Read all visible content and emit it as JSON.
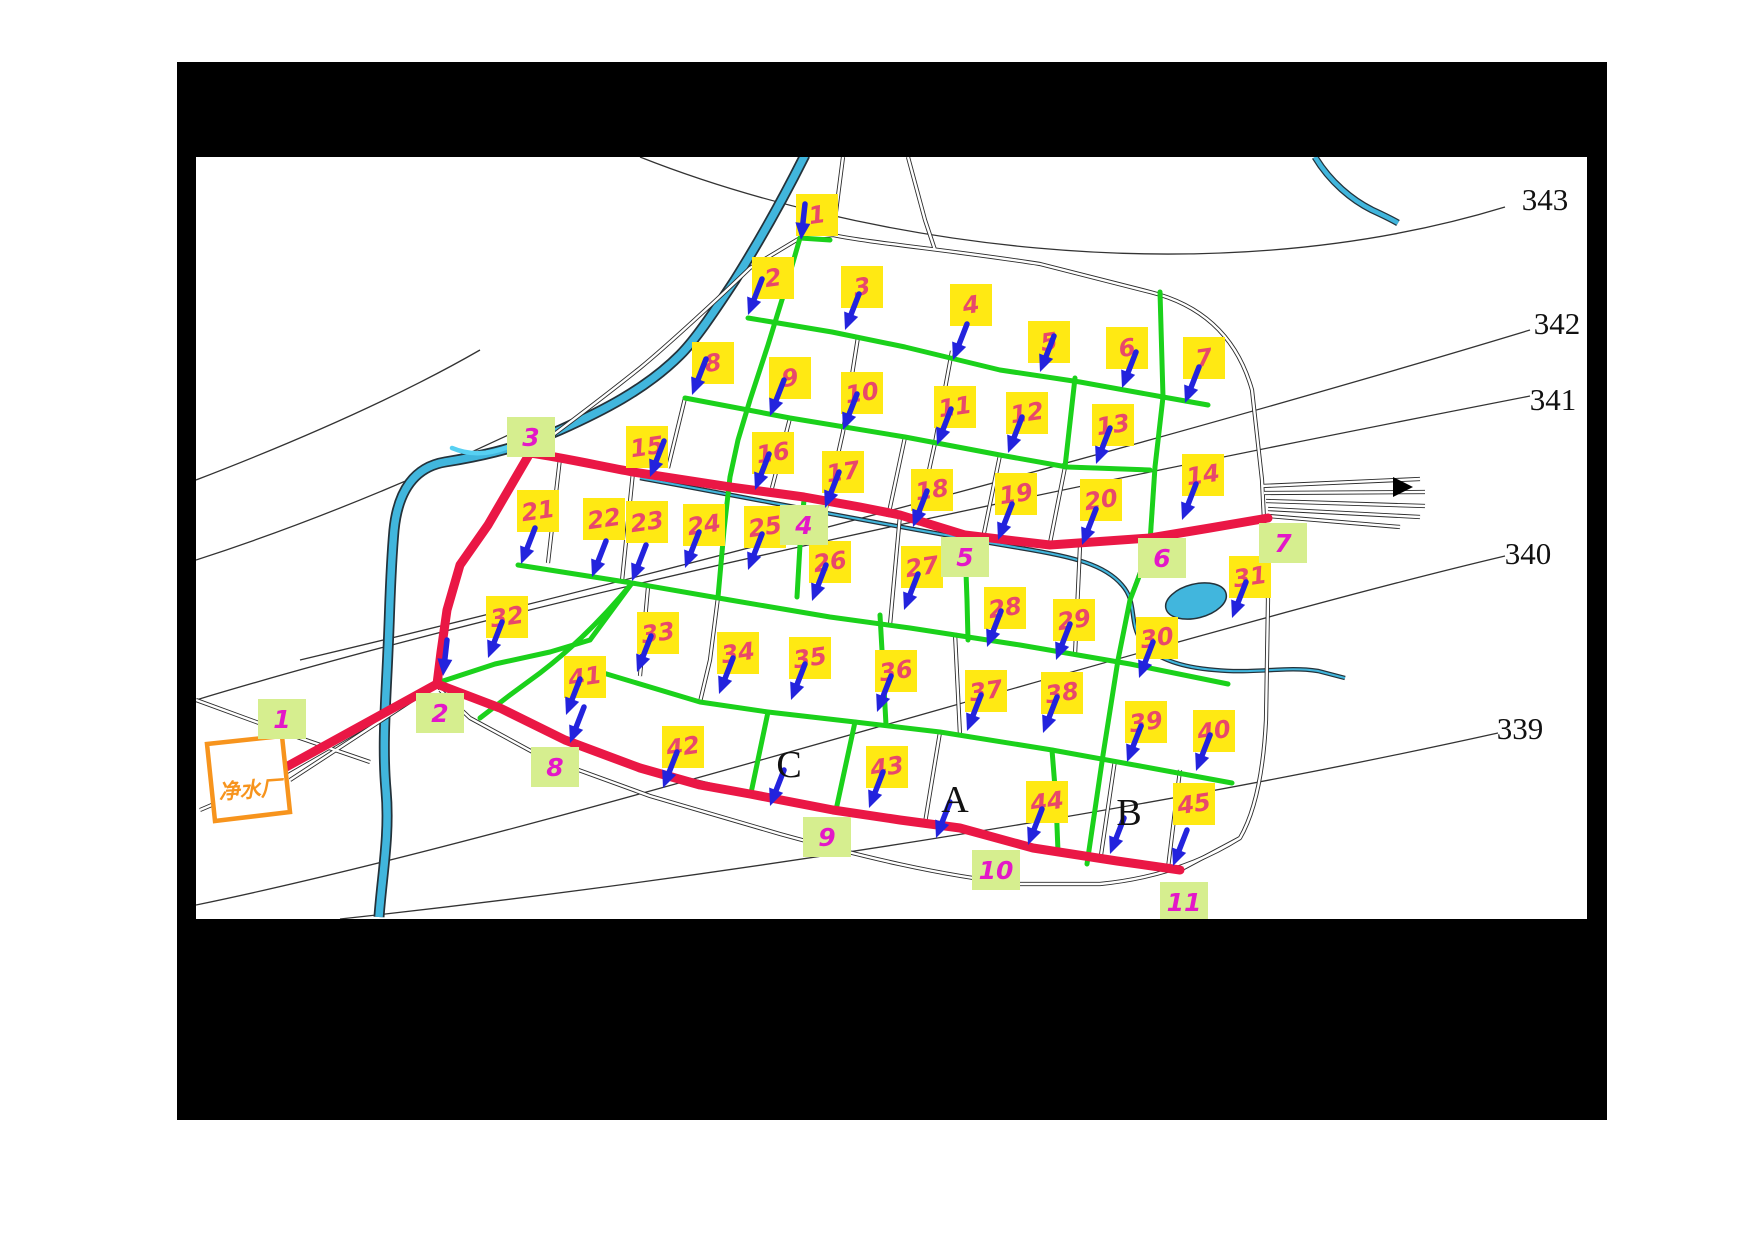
{
  "map": {
    "title": "water-supply-network-plan",
    "plant": {
      "label": "净水厂"
    },
    "contour_labels": [
      {
        "text": "343",
        "x": 1545,
        "y": 199
      },
      {
        "text": "342",
        "x": 1557,
        "y": 323
      },
      {
        "text": "341",
        "x": 1553,
        "y": 399
      },
      {
        "text": "340",
        "x": 1528,
        "y": 553
      },
      {
        "text": "339",
        "x": 1520,
        "y": 728
      }
    ],
    "block_letters": [
      {
        "text": "C",
        "x": 789,
        "y": 765
      },
      {
        "text": "A",
        "x": 955,
        "y": 800
      },
      {
        "text": "B",
        "x": 1129,
        "y": 813
      }
    ],
    "yellow_nodes": [
      {
        "id": "1",
        "x": 817,
        "y": 215
      },
      {
        "id": "2",
        "x": 773,
        "y": 278
      },
      {
        "id": "3",
        "x": 862,
        "y": 287
      },
      {
        "id": "4",
        "x": 971,
        "y": 305
      },
      {
        "id": "5",
        "x": 1049,
        "y": 342
      },
      {
        "id": "6",
        "x": 1127,
        "y": 348
      },
      {
        "id": "7",
        "x": 1204,
        "y": 358
      },
      {
        "id": "8",
        "x": 713,
        "y": 363
      },
      {
        "id": "9",
        "x": 790,
        "y": 378
      },
      {
        "id": "10",
        "x": 862,
        "y": 393
      },
      {
        "id": "11",
        "x": 955,
        "y": 407
      },
      {
        "id": "12",
        "x": 1027,
        "y": 413
      },
      {
        "id": "13",
        "x": 1113,
        "y": 425
      },
      {
        "id": "14",
        "x": 1203,
        "y": 475
      },
      {
        "id": "15",
        "x": 647,
        "y": 447
      },
      {
        "id": "16",
        "x": 773,
        "y": 453
      },
      {
        "id": "17",
        "x": 843,
        "y": 472
      },
      {
        "id": "18",
        "x": 932,
        "y": 490
      },
      {
        "id": "19",
        "x": 1016,
        "y": 494
      },
      {
        "id": "20",
        "x": 1101,
        "y": 500
      },
      {
        "id": "21",
        "x": 538,
        "y": 511
      },
      {
        "id": "22",
        "x": 604,
        "y": 519
      },
      {
        "id": "23",
        "x": 647,
        "y": 522
      },
      {
        "id": "24",
        "x": 704,
        "y": 525
      },
      {
        "id": "25",
        "x": 765,
        "y": 527
      },
      {
        "id": "26",
        "x": 830,
        "y": 562
      },
      {
        "id": "27",
        "x": 922,
        "y": 567
      },
      {
        "id": "28",
        "x": 1005,
        "y": 608
      },
      {
        "id": "29",
        "x": 1074,
        "y": 620
      },
      {
        "id": "30",
        "x": 1157,
        "y": 638
      },
      {
        "id": "31",
        "x": 1250,
        "y": 577
      },
      {
        "id": "32",
        "x": 507,
        "y": 617
      },
      {
        "id": "33",
        "x": 658,
        "y": 633
      },
      {
        "id": "34",
        "x": 738,
        "y": 653
      },
      {
        "id": "35",
        "x": 810,
        "y": 658
      },
      {
        "id": "36",
        "x": 896,
        "y": 671
      },
      {
        "id": "37",
        "x": 986,
        "y": 691
      },
      {
        "id": "38",
        "x": 1062,
        "y": 693
      },
      {
        "id": "39",
        "x": 1146,
        "y": 722
      },
      {
        "id": "40",
        "x": 1214,
        "y": 731
      },
      {
        "id": "41",
        "x": 585,
        "y": 677
      },
      {
        "id": "42",
        "x": 683,
        "y": 747
      },
      {
        "id": "43",
        "x": 887,
        "y": 767
      },
      {
        "id": "44",
        "x": 1047,
        "y": 802
      },
      {
        "id": "45",
        "x": 1194,
        "y": 804
      }
    ],
    "green_nodes": [
      {
        "id": "1",
        "x": 282,
        "y": 719
      },
      {
        "id": "2",
        "x": 440,
        "y": 713
      },
      {
        "id": "3",
        "x": 531,
        "y": 437
      },
      {
        "id": "4",
        "x": 804,
        "y": 525
      },
      {
        "id": "5",
        "x": 965,
        "y": 557
      },
      {
        "id": "6",
        "x": 1162,
        "y": 558
      },
      {
        "id": "7",
        "x": 1283,
        "y": 543
      },
      {
        "id": "8",
        "x": 555,
        "y": 767
      },
      {
        "id": "9",
        "x": 827,
        "y": 837
      },
      {
        "id": "10",
        "x": 996,
        "y": 870
      },
      {
        "id": "11",
        "x": 1184,
        "y": 902
      }
    ],
    "arrows": [
      {
        "x": 801,
        "y": 240,
        "v": true
      },
      {
        "x": 748,
        "y": 315
      },
      {
        "x": 845,
        "y": 330
      },
      {
        "x": 953,
        "y": 360
      },
      {
        "x": 1040,
        "y": 372
      },
      {
        "x": 1122,
        "y": 388
      },
      {
        "x": 1185,
        "y": 403
      },
      {
        "x": 692,
        "y": 395
      },
      {
        "x": 770,
        "y": 416
      },
      {
        "x": 843,
        "y": 430
      },
      {
        "x": 937,
        "y": 445
      },
      {
        "x": 1008,
        "y": 453
      },
      {
        "x": 1096,
        "y": 464
      },
      {
        "x": 1182,
        "y": 520
      },
      {
        "x": 650,
        "y": 477
      },
      {
        "x": 755,
        "y": 490
      },
      {
        "x": 825,
        "y": 508
      },
      {
        "x": 913,
        "y": 527
      },
      {
        "x": 998,
        "y": 540
      },
      {
        "x": 1082,
        "y": 545
      },
      {
        "x": 521,
        "y": 564
      },
      {
        "x": 592,
        "y": 577
      },
      {
        "x": 632,
        "y": 581
      },
      {
        "x": 685,
        "y": 568
      },
      {
        "x": 748,
        "y": 570
      },
      {
        "x": 812,
        "y": 601
      },
      {
        "x": 904,
        "y": 610
      },
      {
        "x": 987,
        "y": 647
      },
      {
        "x": 1056,
        "y": 660
      },
      {
        "x": 1139,
        "y": 678
      },
      {
        "x": 1232,
        "y": 618
      },
      {
        "x": 488,
        "y": 658
      },
      {
        "x": 637,
        "y": 672
      },
      {
        "x": 719,
        "y": 694
      },
      {
        "x": 791,
        "y": 700
      },
      {
        "x": 877,
        "y": 712
      },
      {
        "x": 967,
        "y": 731
      },
      {
        "x": 1043,
        "y": 733
      },
      {
        "x": 1127,
        "y": 762
      },
      {
        "x": 1196,
        "y": 771
      },
      {
        "x": 566,
        "y": 715
      },
      {
        "x": 663,
        "y": 788
      },
      {
        "x": 869,
        "y": 808
      },
      {
        "x": 1028,
        "y": 845
      },
      {
        "x": 1173,
        "y": 866
      },
      {
        "x": 770,
        "y": 806
      },
      {
        "x": 936,
        "y": 838
      },
      {
        "x": 1110,
        "y": 854
      },
      {
        "x": 443,
        "y": 676,
        "v": true
      },
      {
        "x": 570,
        "y": 743
      }
    ],
    "colors": {
      "frame": "#000000",
      "paper": "#ffffff",
      "trunk_red": "#ea1745",
      "pipe_green": "#1bd11b",
      "node_box": "#ffe913",
      "node_text": "#e8486b",
      "junction_box": "#d6ee8f",
      "junction_text": "#e318c8",
      "arrow_blue": "#2323dd",
      "river_fill": "#41b6dd",
      "river_edge": "#24323a",
      "creek_cyan": "#57d0f2",
      "plant_orange": "#f7941d",
      "road": "#2b2b2b",
      "contour": "#333333",
      "letter_text": "#111111"
    }
  }
}
